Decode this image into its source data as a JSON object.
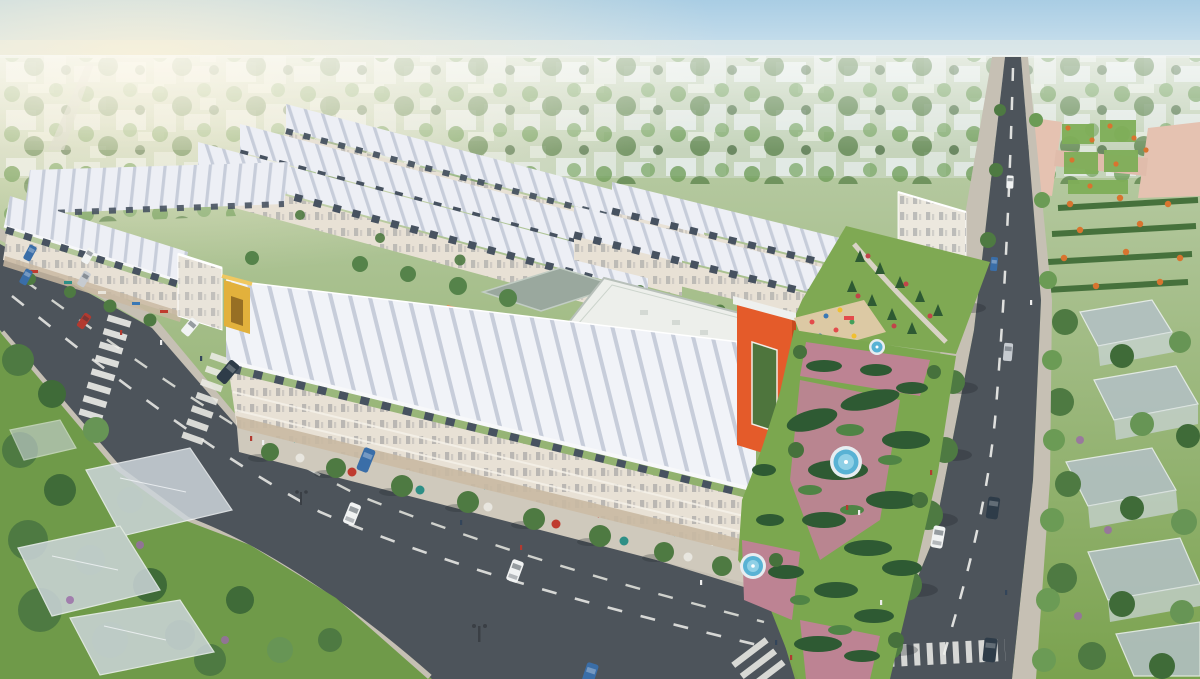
{
  "scene": {
    "kind": "3d-aerial-architectural-render",
    "description": "Aerial 3D rendering of a planned residential development: long rows of white-roofed shophouses around an orange kindergarten with playground, a formal fountain garden with hedge parterres, tree-lined boulevards with cars and pedestrians, a pink paved flower plaza, and semi-transparent future-phase villas among dense trees"
  },
  "landmarks": {
    "shophouse_rows": "white ridged-roof shophouse rows",
    "kindergarten": "orange kindergarten building with tower",
    "fountain_garden": "formal garden with three fountains",
    "boulevard": "diagonal boulevard with crosswalks",
    "main_road": "vertical avenue with street trees",
    "flower_plaza": "pink paved flower plaza",
    "future_villas": "translucent future-phase villas",
    "entrance_gate": "yellow project entrance gate"
  },
  "colors": {
    "sky_top": "#a9cde4",
    "sky_mid": "#cfe3ee",
    "sky_horizon": "#edf2ee",
    "sun_glow": "#fbf2d9",
    "land_far": "#c2d1b2",
    "lawn_green": "#7aa24e",
    "lawn_dark": "#6f9a49",
    "distant_haze": "#ccd9c6",
    "distant_block": "#eef2f5",
    "tree_green": "#6b9b55",
    "tree_deep": "#4e7a42",
    "asphalt": "#4d545b",
    "sidewalk": "#c6c0b4",
    "lane_marking": "#f0f0ec",
    "roof_white": "#edeff5",
    "roof_ridge": "#c7cdda",
    "facade_cream": "#e8e1d5",
    "shop_tan": "#c9b9a2",
    "dormer_slate": "#475260",
    "school_orange": "#e45b2a",
    "school_orange_dark": "#c74a1e",
    "school_roof": "#edefeb",
    "annex_roof": "#9aa89e",
    "gate_yellow": "#e2b13c",
    "plaza_pink": "#e5c2b1",
    "path_pink": "#bd8393",
    "hedge_dark": "#2e5a33",
    "fountain_water": "#58b2d4",
    "fountain_rim": "#e7edf1",
    "villa_ghost": "#ccd5da",
    "villa_roof": "#b4c1c7",
    "car_white": "#f1f3f3",
    "car_dark": "#2e3c49",
    "car_blue": "#3a6ea8",
    "car_red": "#b23a30",
    "car_silver": "#c6cbd0",
    "flower_orange": "#d8742f",
    "flower_red": "#c14449"
  }
}
